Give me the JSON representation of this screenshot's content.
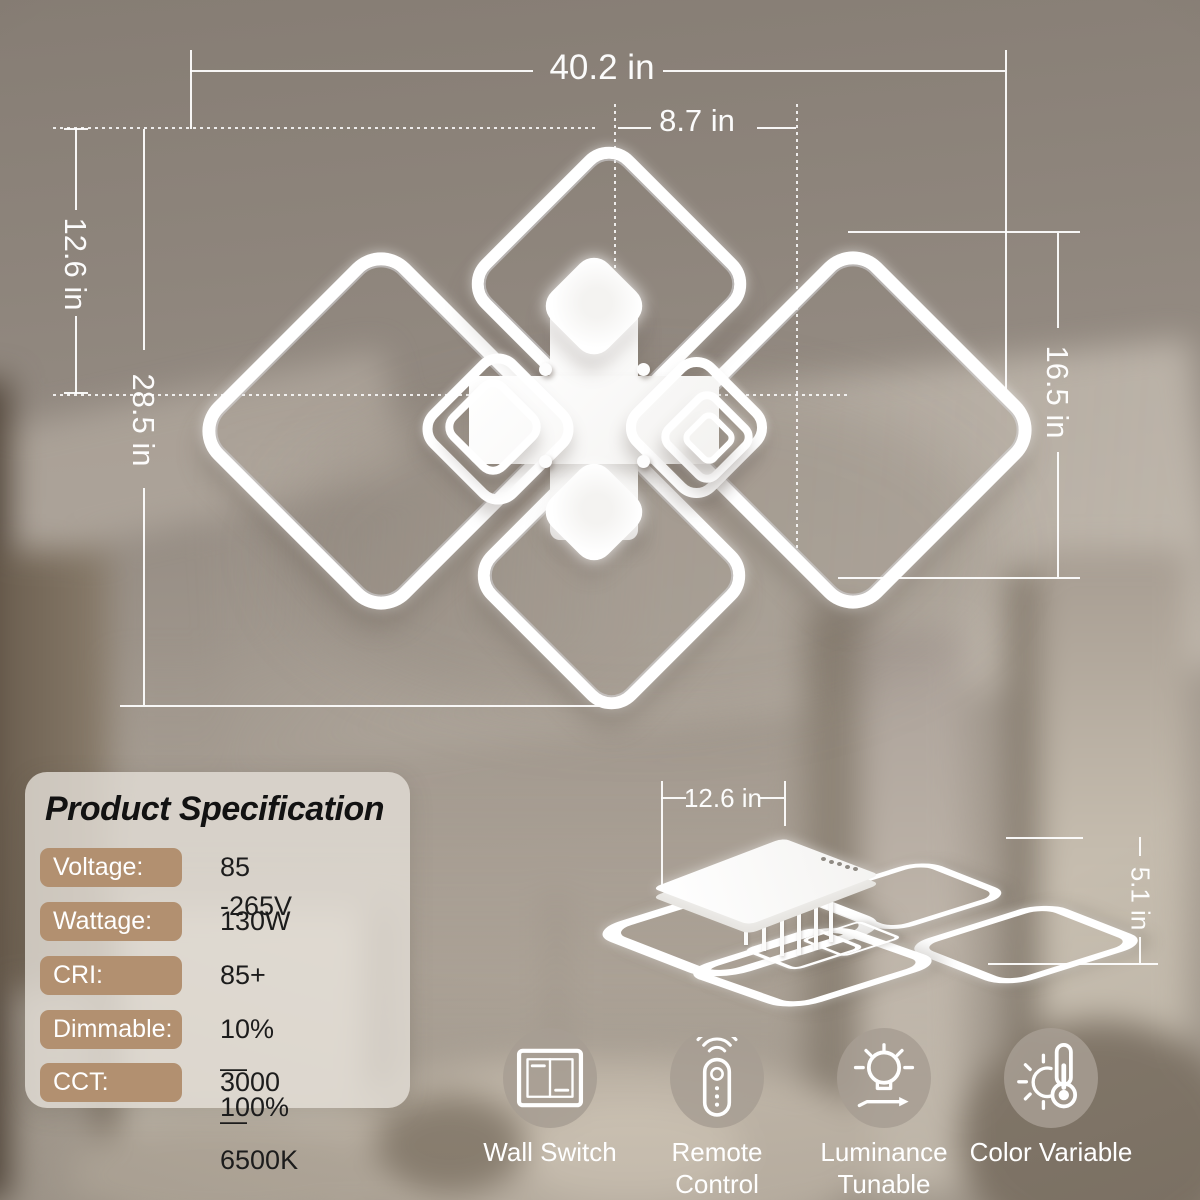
{
  "colors": {
    "badge": "#b29070",
    "panel_bg": "rgba(228,222,215,0.80)",
    "icon_circle": "rgba(167,158,147,0.85)",
    "dim_line": "#ffffff"
  },
  "main_view": {
    "width_total": "40.2 in",
    "center_square": "8.7 in",
    "left_small": "12.6 in",
    "left_large": "28.5 in",
    "right_height": "16.5 in"
  },
  "side_view": {
    "base_width": "12.6 in",
    "height": "5.1 in"
  },
  "spec": {
    "title": "Product Specification",
    "rows": [
      {
        "label": "Voltage:",
        "value": "85 -265V"
      },
      {
        "label": "Wattage:",
        "value": "130W"
      },
      {
        "label": "CRI:",
        "value": "85+"
      },
      {
        "label": "Dimmable:",
        "value": "10%—100%"
      },
      {
        "label": "CCT:",
        "value": "3000—6500K"
      }
    ]
  },
  "features": [
    {
      "icon": "wall-switch-icon",
      "lines": [
        "Wall Switch",
        ""
      ]
    },
    {
      "icon": "remote-control-icon",
      "lines": [
        "Remote",
        "Control"
      ]
    },
    {
      "icon": "luminance-tunable-icon",
      "lines": [
        "Luminance",
        "Tunable"
      ]
    },
    {
      "icon": "color-variable-icon",
      "lines": [
        "Color Variable",
        ""
      ]
    }
  ]
}
